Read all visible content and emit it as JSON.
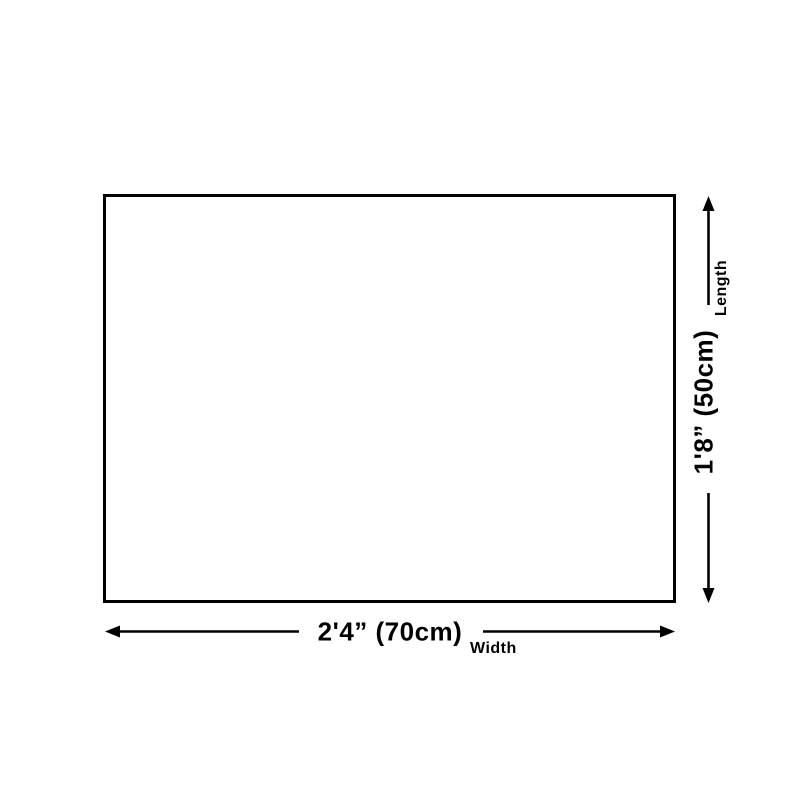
{
  "diagram": {
    "title": "product-dimension-diagram",
    "rectangle": {
      "description": "empty dimensioned panel",
      "border_color": "#000000",
      "fill_color": "#ffffff"
    },
    "width_dimension": {
      "value": "2'4” (70cm)",
      "label": "Width"
    },
    "length_dimension": {
      "value": "1'8” (50cm)",
      "label": "Length"
    },
    "colors": {
      "line": "#000000",
      "background": "#ffffff",
      "text": "#000000"
    }
  }
}
